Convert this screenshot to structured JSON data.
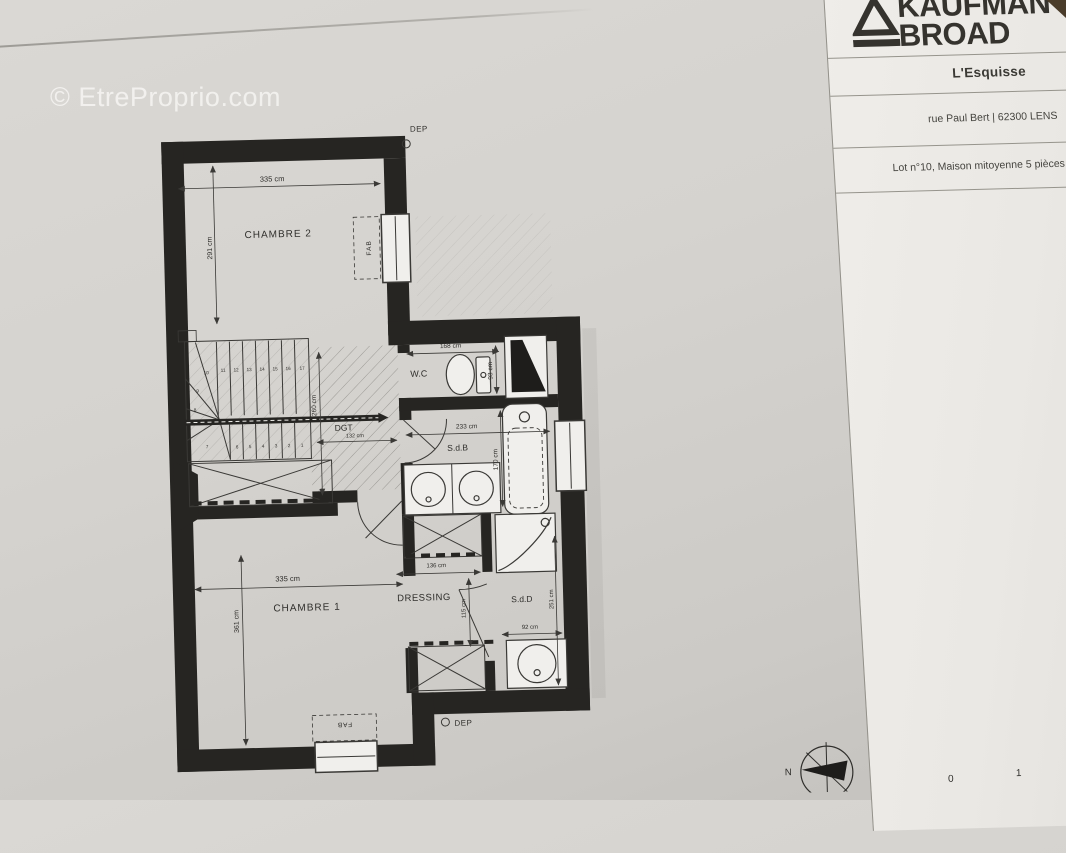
{
  "watermark": {
    "text": "© EtreProprio.com"
  },
  "title_block": {
    "brand_top": "KAUFMAN",
    "brand_bottom": "BROAD",
    "program": "L'Esquisse",
    "address": "rue Paul Bert | 62300 LENS",
    "lot": "Lot n°10, Maison mitoyenne 5 pièces"
  },
  "plan": {
    "rooms": {
      "chambre2": "CHAMBRE 2",
      "chambre1": "CHAMBRE 1",
      "wc": "W.C",
      "sdb": "S.d.B",
      "dgt": "DGT",
      "dressing": "DRESSING",
      "sdd": "S.d.D"
    },
    "dims": {
      "chambre2_w": "335 cm",
      "chambre2_d": "291 cm",
      "chambre1_w": "335 cm",
      "chambre1_d": "361 cm",
      "wc_w": "168 cm",
      "wc_d": "93 cm",
      "sdb_w": "233 cm",
      "sdb_d": "170 cm",
      "dgt_w": "132 cm",
      "dgt_d": "260 cm",
      "dressing_w": "136 cm",
      "dressing_d": "115 cm",
      "sdd_w": "92 cm",
      "sdd_d": "251 cm"
    },
    "annotations": {
      "dep_top": "DEP",
      "dep_bottom": "DEP",
      "fab_right": "FAB",
      "fab_bottom": "FAB",
      "north": "N"
    },
    "stairs": {
      "steps": [
        "1",
        "2",
        "3",
        "4",
        "5",
        "6",
        "7",
        "8",
        "9",
        "10",
        "11",
        "12",
        "13",
        "14",
        "15",
        "16",
        "17"
      ]
    },
    "scale_bar": {
      "start": "0",
      "end": "1"
    }
  },
  "colors": {
    "ink": "#262522",
    "paper": "#d5d3cf",
    "panel_paper": "#edebe7"
  }
}
